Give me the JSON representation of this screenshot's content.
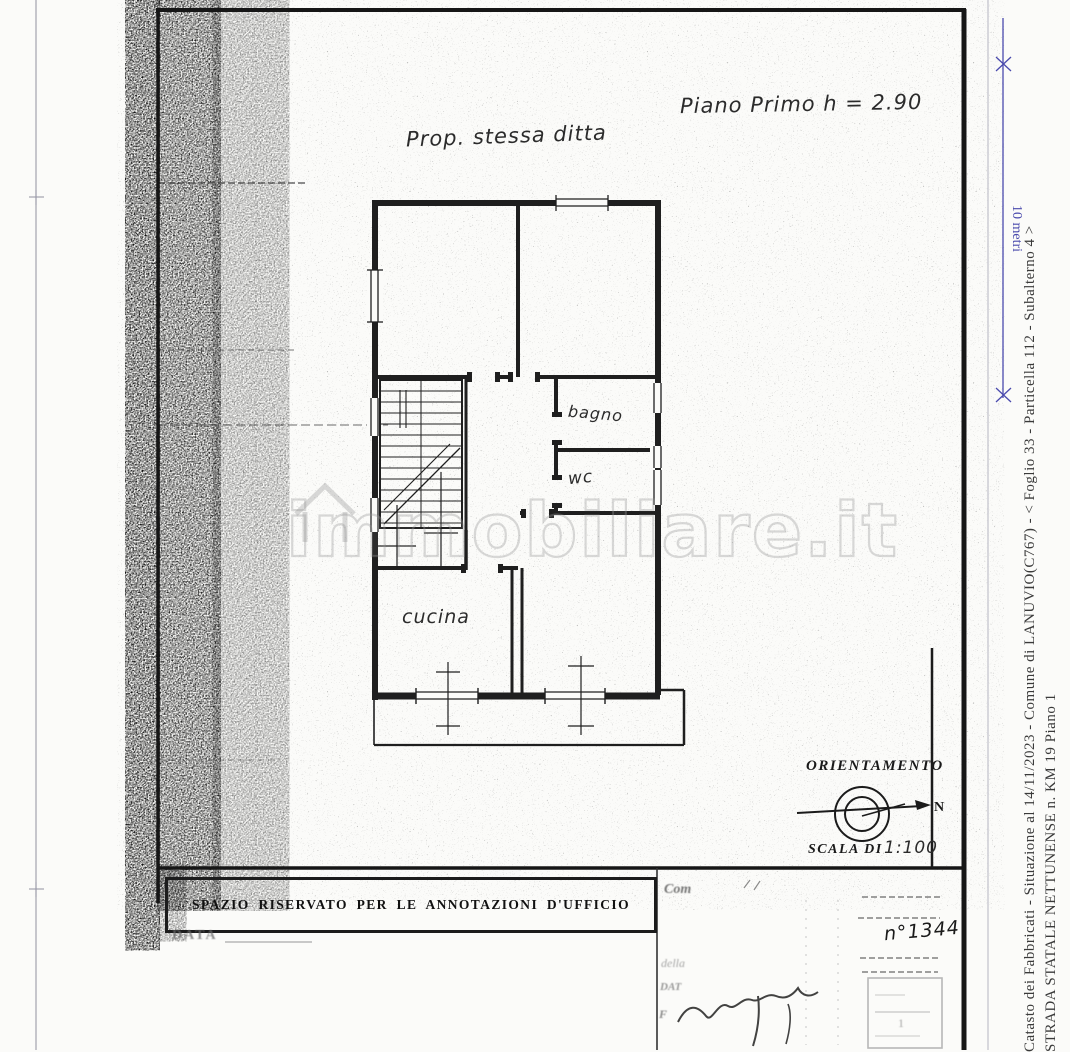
{
  "watermark": {
    "text": "immobiliare.it"
  },
  "plan": {
    "property_note": "Prop. stessa ditta",
    "floor_title": "Piano Primo h = 2.90",
    "rooms": {
      "bathroom": "bagno",
      "wc": "wc",
      "kitchen": "cucina"
    }
  },
  "orientation": {
    "title": "ORIENTAMENTO",
    "north": "N",
    "scale_label": "SCALA DI",
    "scale_value": "1:100"
  },
  "scale_bar": {
    "label": "10 metri"
  },
  "office_section": {
    "title": "SPAZIO RISERVATO PER LE ANNOTAZIONI D'UFFICIO",
    "date_label": "DATA"
  },
  "stamp_section": {
    "com_label": "Com",
    "della_label": "della",
    "dat_label": "DAT",
    "firma_label": "F",
    "protocol_number": "n°1344",
    "stamp_digit": "1"
  },
  "side_captions": {
    "line1": "Catasto dei Fabbricati - Situazione al 14/11/2023 - Comune di LANUVIO(C767) - <  Foglio 33 - Particella  112 - Subalterno 4 >",
    "line2": "STRADA STATALE NETTUNENSE n. KM 19 Piano 1"
  }
}
